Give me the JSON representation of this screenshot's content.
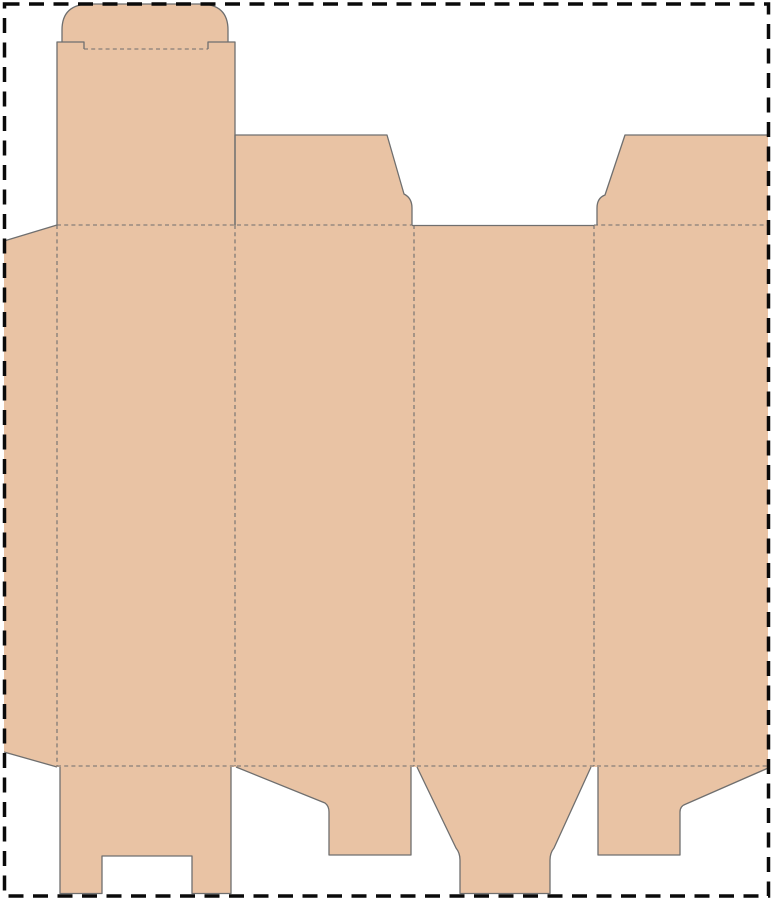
{
  "canvas": {
    "width": 773,
    "height": 900,
    "background_color": "#ffffff"
  },
  "sheet": {
    "border_color": "#0a0a0a",
    "border_width": 3.5,
    "border_dash": "15 9.5",
    "x": 4.5,
    "y": 4,
    "width": 764,
    "height": 892
  },
  "dieline": {
    "fill_color": "#e9c3a4",
    "cut_color": "#6f6f6f",
    "cut_width": 1.3,
    "fold_color": "#6e6e6e",
    "fold_width": 1.1,
    "fold_dash": "4 3.2",
    "outline": "M4,241 L57,225 L57,42 L62,42 L62,30 Q62,4 90,4 L200,4 Q228,4 228,30 L228,42 L235,42 L235,135 L387,135 L404,194 Q412,198 412,208 L412,225 L594,225 L597,225 L597,208 Q597,198 605,195 L625,135 L768,135 L768,769 L686,804 Q680,806 680,812 L680,855 L598,855 L598,767 L591,767 L554,848 Q550,853 550,860 L550,894 L460,894 L460,860 Q460,853 456,848 L417,767 L411,767 L411,855 L329,855 L329,812 Q329,806 325,803 L236,767 L231,767 L231,894 L192,894 L192,856 L102,856 L102,894 L60,894 L60,767 L57,767 L4,752 Z",
    "cuts": [
      "M4,241 L57,225",
      "M57,225 L57,42 L84,42 L84,49",
      "M62,42 L62,30 Q62,4 90,4 L200,4 Q228,4 228,30 L228,42",
      "M208,49 L208,42 L235,42 L235,225",
      "M235,225 L235,135 L387,135 L404,194 Q412,198 412,208 L412,225",
      "M412,225.5 L594,225.5",
      "M597,225 L597,208 Q597,198 605,195 L625,135 L768,135",
      "M60,767 L60,893.5 L102,893.5 L102,856 L192,856 L192,893.5 L231,893.5 L231,767",
      "M236,767 L325,803 Q329,806 329,812 L329,855 L411,855 L411,767",
      "M417,767 L456,848 Q460,853 460,860 L460,893.5 L550,893.5 L550,860 Q550,853 554,848 L591,767",
      "M598,767 L598,855 L680,855 L680,812 Q680,806 686,804 L767,768.5",
      "M4,752 L57,767"
    ],
    "folds": [
      "M84,49 L208,49",
      "M57,225 L412,225",
      "M594,225 L767,225",
      "M57,766 L767,766",
      "M57,225 L57,766",
      "M235,225 L235,766",
      "M414,225 L414,766",
      "M594,225 L594,766"
    ]
  }
}
